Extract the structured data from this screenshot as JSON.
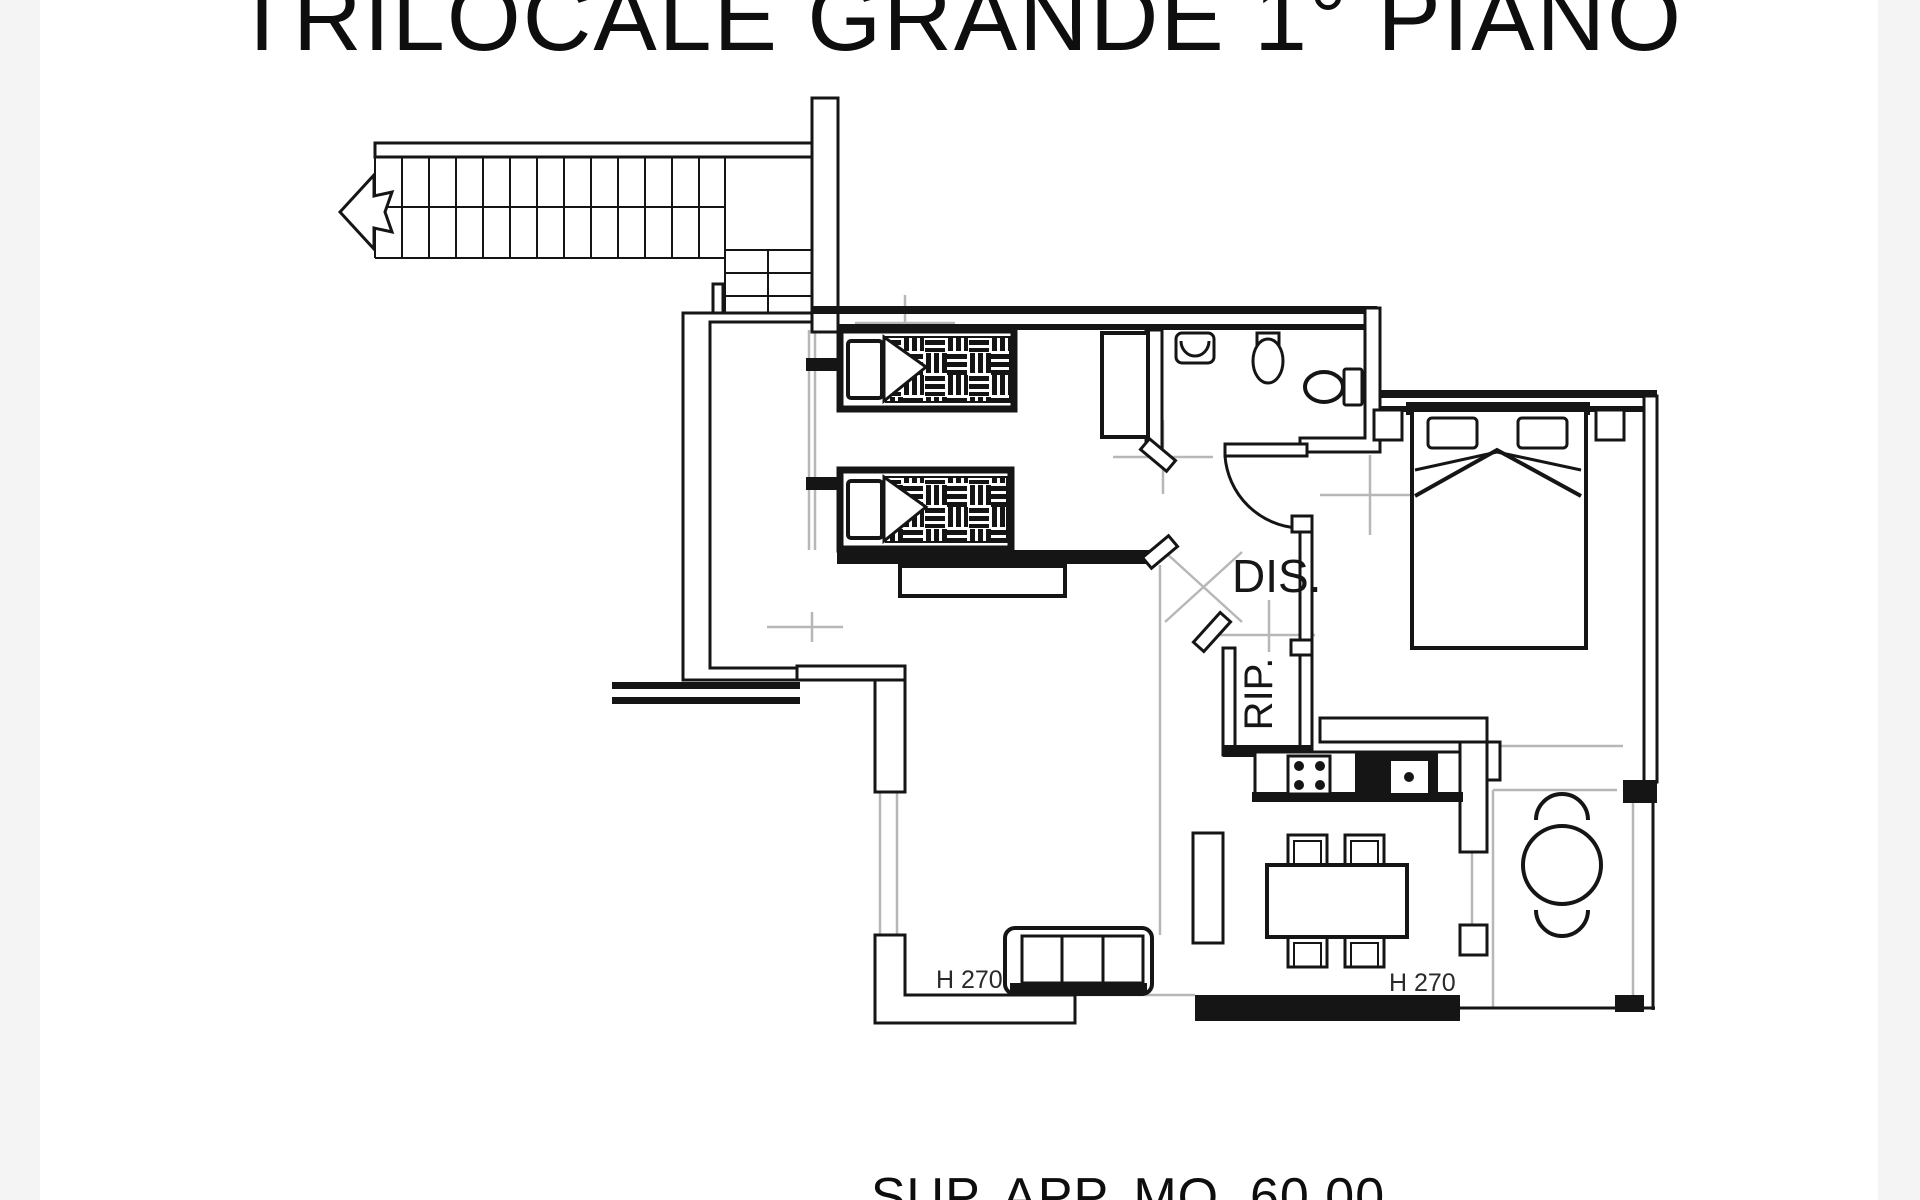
{
  "plan": {
    "title": "TRILOCALE GRANDE 1° PIANO",
    "area_label": "SUP. APP. MQ. 60,00",
    "rooms": {
      "hallway": "DIS.",
      "storage": "RIP."
    },
    "ceiling_heights": {
      "living": "H 270",
      "dining": "H 270"
    },
    "colors": {
      "line": "#151515",
      "construction_marks": "#b7b7b7",
      "paper": "#ffffff",
      "page_edge": "#f4f4f4"
    }
  }
}
